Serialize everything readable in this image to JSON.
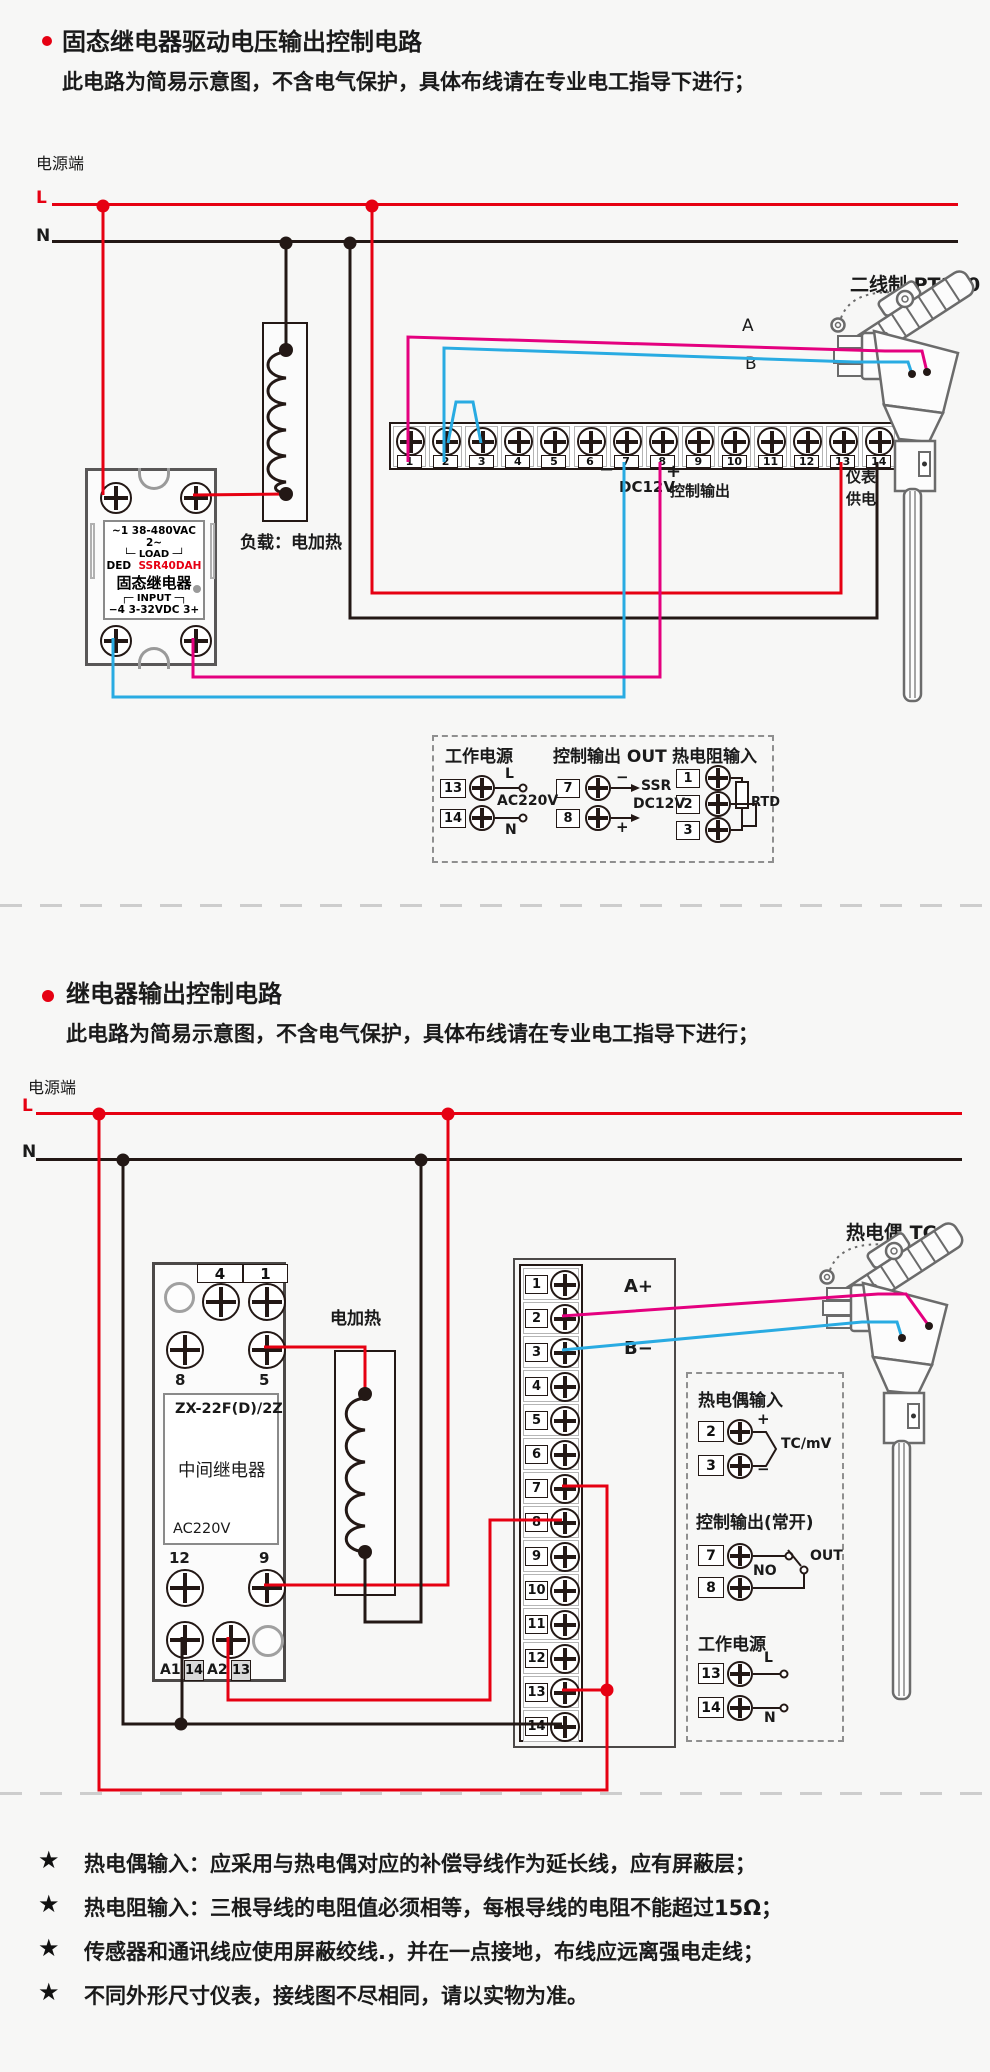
{
  "colors": {
    "red": "#e60012",
    "magenta": "#e4007f",
    "blue": "#29abe2",
    "black": "#231815"
  },
  "section1": {
    "title": "固态继电器驱动电压输出控制电路",
    "subtitle": "此电路为简易示意图，不含电气保护，具体布线请在专业电工指导下进行；",
    "power_label": "电源端",
    "l_label": "L",
    "n_label": "N",
    "ssr": {
      "line_top": "~1  38-480VAC  2~",
      "line_load": "└─ LOAD ─┘",
      "brand": "DED",
      "model": "SSR40DAH",
      "name": "固态继电器",
      "line_input": "┌─ INPUT ─┐",
      "line_bottom": "−4  3-32VDC  3+"
    },
    "heater_label": "负载：电加热",
    "strip": {
      "terminals": [
        "1",
        "2",
        "3",
        "4",
        "5",
        "6",
        "7",
        "8",
        "9",
        "10",
        "11",
        "12",
        "13",
        "14"
      ],
      "minus": "−",
      "dc12v": "DC12V",
      "plus": "+",
      "ctrl_out": "控制输出",
      "meter1": "仪表",
      "meter2": "供电"
    },
    "sensor_label": "二线制 PT100",
    "wire_a": "A",
    "wire_b": "B",
    "legend": {
      "g1": {
        "title": "工作电源",
        "n1": "13",
        "n2": "14",
        "l": "L",
        "mid": "AC220V",
        "n": "N"
      },
      "g2": {
        "title": "控制输出 OUT",
        "n1": "7",
        "n2": "8",
        "minus": "−",
        "plus": "+",
        "l1": "SSR",
        "l2": "DC12V"
      },
      "g3": {
        "title": "热电阻输入",
        "n1": "1",
        "n2": "2",
        "n3": "3",
        "tag": "RTD"
      }
    }
  },
  "section2": {
    "title": "继电器输出控制电路",
    "subtitle": "此电路为简易示意图，不含电气保护，具体布线请在专业电工指导下进行；",
    "power_label": "电源端",
    "l_label": "L",
    "n_label": "N",
    "relay": {
      "t4": "4",
      "t1": "1",
      "t8": "8",
      "t5": "5",
      "model": "ZX-22F(D)/2Z",
      "name": "中间继电器",
      "voltage": "AC220V",
      "t12": "12",
      "t9": "9",
      "a1": "A1",
      "t14": "14",
      "a2": "A2",
      "t13": "13"
    },
    "heater_label": "电加热",
    "strip": {
      "terminals": [
        "1",
        "2",
        "3",
        "4",
        "5",
        "6",
        "7",
        "8",
        "9",
        "10",
        "11",
        "12",
        "13",
        "14"
      ],
      "a_plus": "A+",
      "b_minus": "B−"
    },
    "sensor_label": "热电偶 TC",
    "legend": {
      "g1": {
        "title": "热电偶输入",
        "n1": "2",
        "n2": "3",
        "plus": "+",
        "minus": "−",
        "tag": "TC/mV"
      },
      "g2": {
        "title": "控制输出(常开)",
        "n1": "7",
        "n2": "8",
        "no": "NO",
        "out": "OUT"
      },
      "g3": {
        "title": "工作电源",
        "n1": "13",
        "n2": "14",
        "l": "L",
        "n": "N"
      }
    }
  },
  "note_bullet": "★",
  "notes": [
    "热电偶输入：应采用与热电偶对应的补偿导线作为延长线，应有屏蔽层；",
    "热电阻输入：三根导线的电阻值必须相等，每根导线的电阻不能超过15Ω；",
    "传感器和通讯线应使用屏蔽绞线.，并在一点接地，布线应远离强电走线；",
    "不同外形尺寸仪表，接线图不尽相同，请以实物为准。"
  ]
}
